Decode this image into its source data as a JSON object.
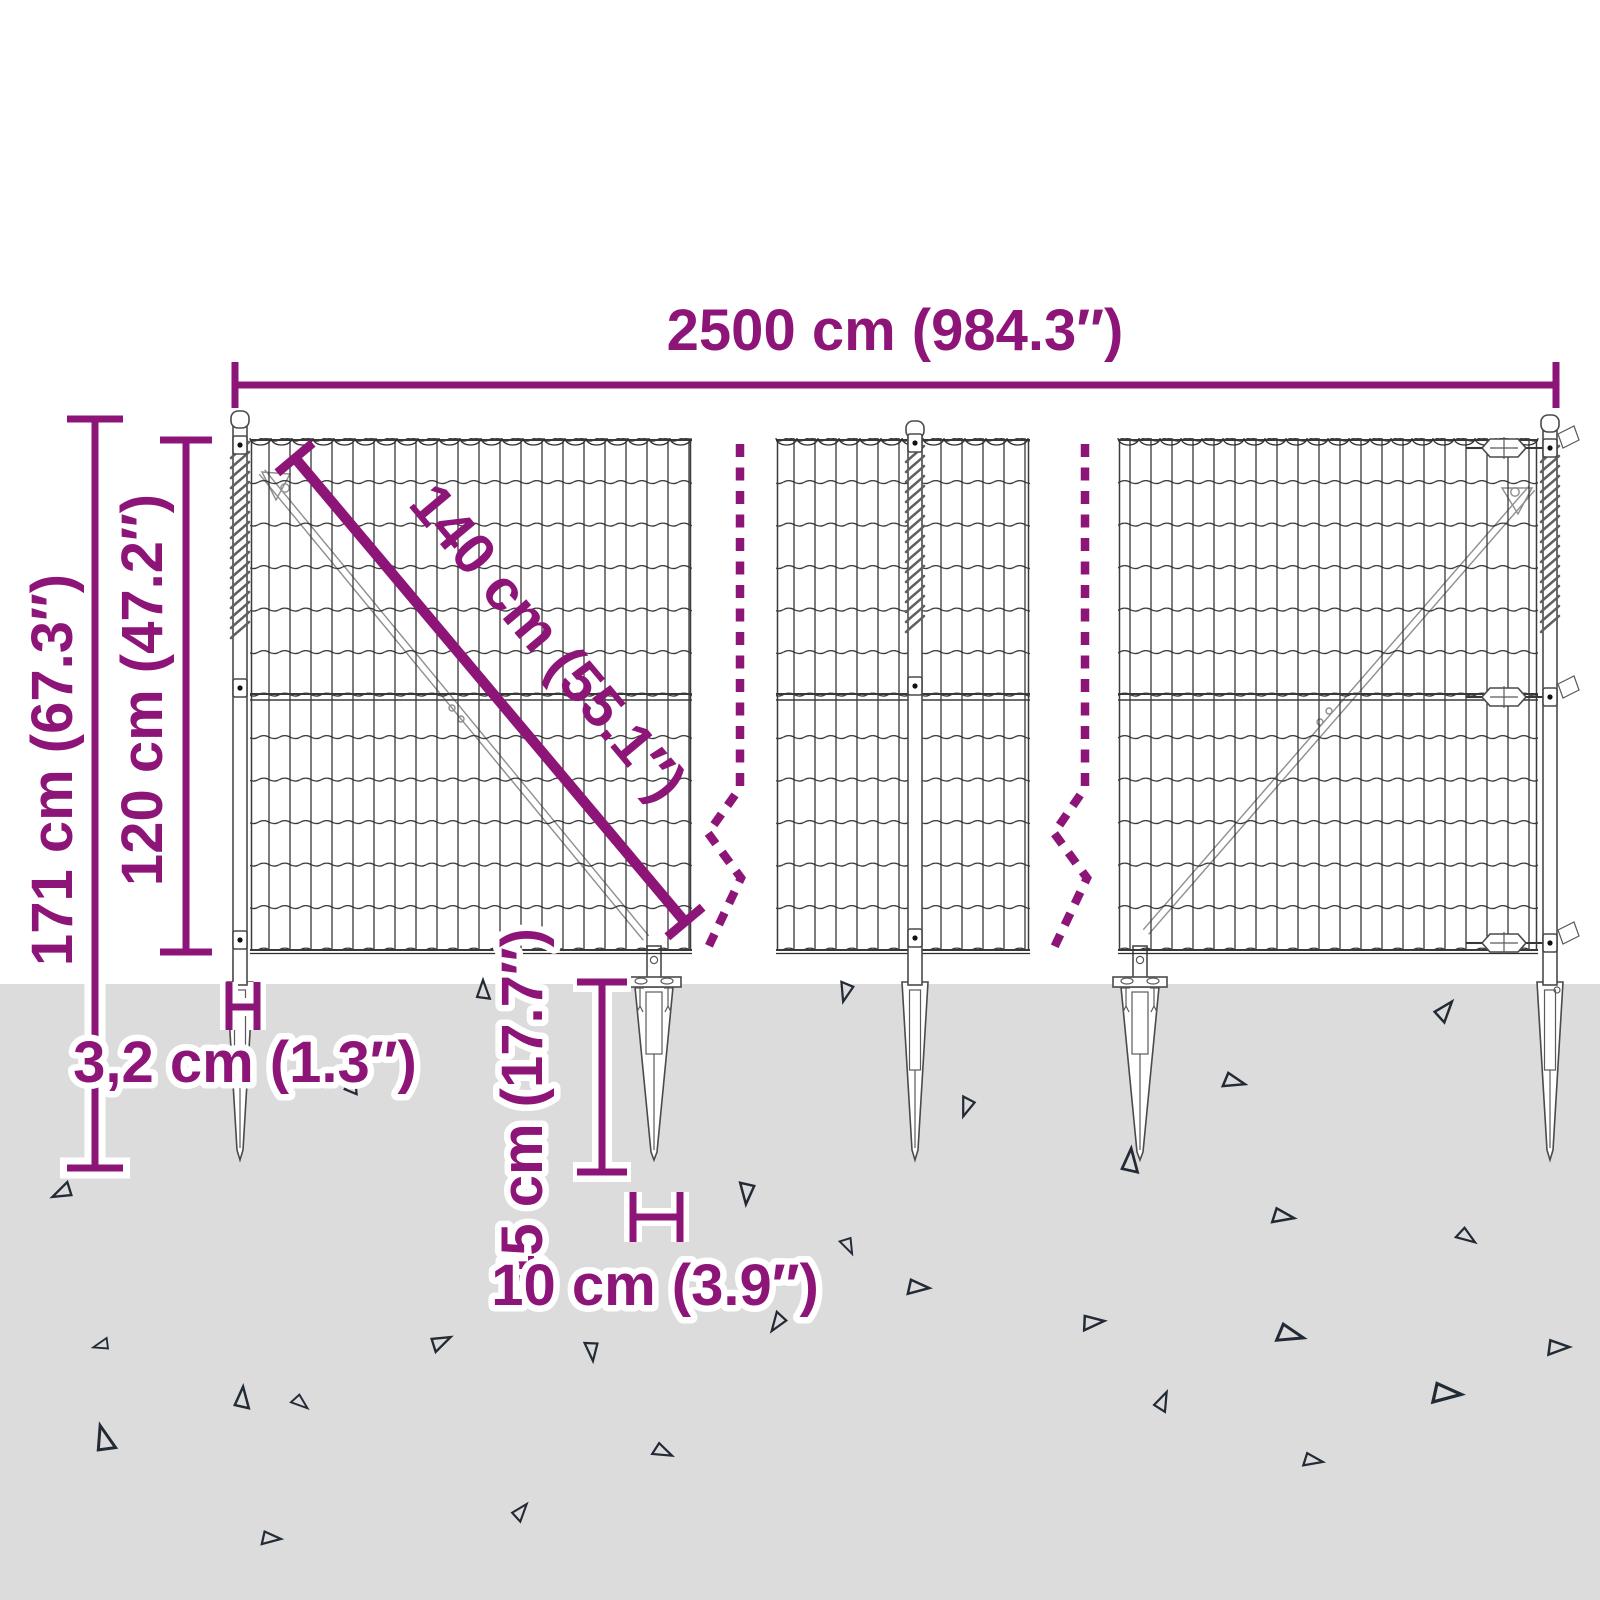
{
  "diagram": {
    "type": "product-dimension-diagram",
    "subject": "wire-mesh-fence-with-ground-spike-anchors",
    "dimensions": {
      "total_width": {
        "label": "2500 cm (984.3″)",
        "value_cm": 2500,
        "value_in": 984.3
      },
      "total_height": {
        "label": "171 cm (67.3″)",
        "value_cm": 171,
        "value_in": 67.3
      },
      "fence_height": {
        "label": "120 cm (47.2″)",
        "value_cm": 120,
        "value_in": 47.2
      },
      "diagonal_brace": {
        "label": "140 cm (55.1″)",
        "value_cm": 140,
        "value_in": 55.1
      },
      "post_width": {
        "label": "3,2 cm (1.3″)",
        "value_cm": 3.2,
        "value_in": 1.3
      },
      "spike_length": {
        "label": "45 cm (17.7″)",
        "value_cm": 45,
        "value_in": 17.7
      },
      "spike_plate_width": {
        "label": "10 cm (3.9″)",
        "value_cm": 10,
        "value_in": 3.9
      }
    },
    "colors": {
      "dimension_purple": "#8E1578",
      "ground_gray": "#DCDCDC",
      "drawing_line": "#2E2E2E",
      "triangle_outline": "#222A36",
      "background": "#FFFFFF"
    },
    "icons": [
      "break-line-icon",
      "ground-debris-triangle-icon",
      "spiral-wire-icon",
      "turnbuckle-icon"
    ]
  }
}
